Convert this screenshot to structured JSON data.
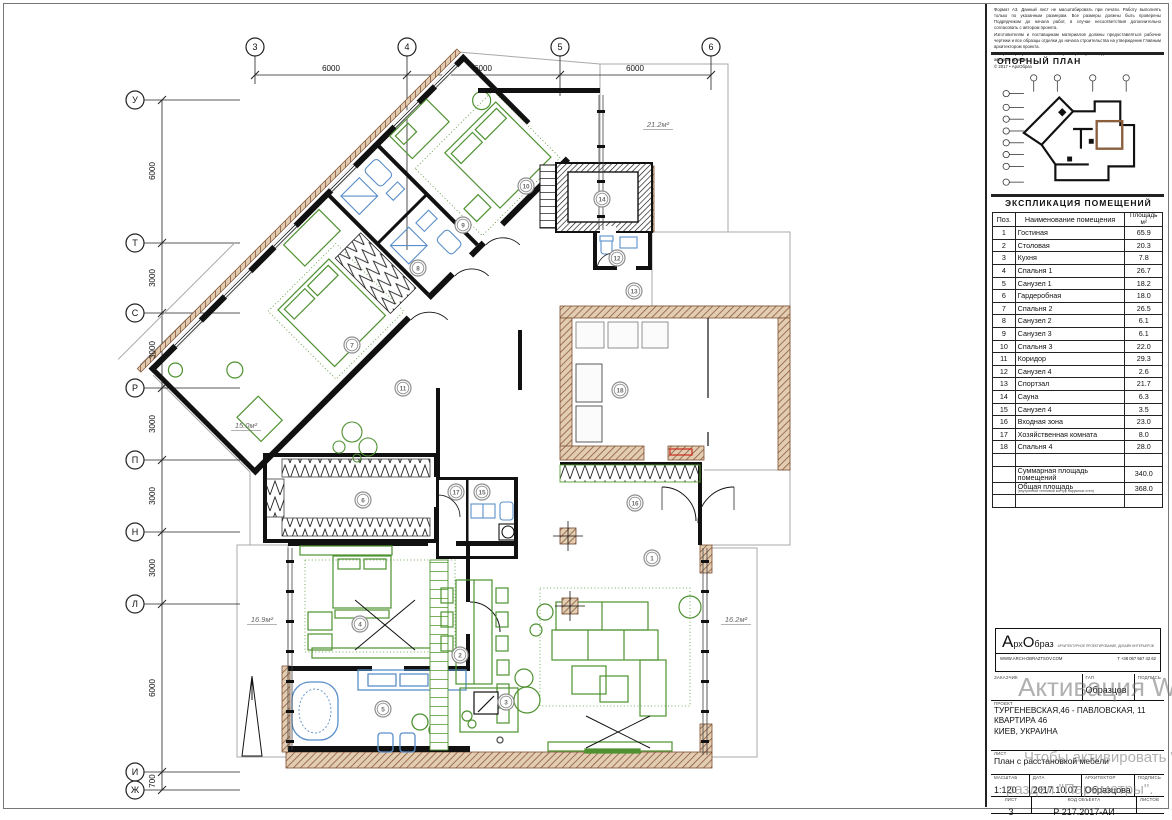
{
  "disclaimer": {
    "p1": "Формат А3. Данный лист не масштабировать при печати. Работу выполнять только по указанным размерам. Все размеры должны быть проверены Подрядчиком до начала работ, в случае несоответствия дополнительно согласовать с автором проекта.",
    "p2": "Изготовителям и поставщикам материалов должны предоставляться рабочие чертежи и все образцы отделки до начала строительства на утверждение Главным архитектором проекта.",
    "p3": "Все размеры указаны в мм, если размер не указан, дополнительно согласовать с автором проекта.",
    "copyright": "© 2017 • АрхОбраз"
  },
  "reference_plan": {
    "title": "ОПОРНЫЙ ПЛАН"
  },
  "explication": {
    "title": "ЭКСПЛИКАЦИЯ ПОМЕЩЕНИЙ",
    "col_pos": "Поз.",
    "col_name": "Наименование помещения",
    "col_area": "Площадь",
    "col_area_unit": "м²",
    "rows": [
      [
        "1",
        "Гостиная",
        "65.9"
      ],
      [
        "2",
        "Столовая",
        "20.3"
      ],
      [
        "3",
        "Кухня",
        "7.8"
      ],
      [
        "4",
        "Спальня 1",
        "26.7"
      ],
      [
        "5",
        "Санузел 1",
        "18.2"
      ],
      [
        "6",
        "Гардеробная",
        "18.0"
      ],
      [
        "7",
        "Спальня 2",
        "26.5"
      ],
      [
        "8",
        "Санузел 2",
        "6.1"
      ],
      [
        "9",
        "Санузел 3",
        "6.1"
      ],
      [
        "10",
        "Спальня 3",
        "22.0"
      ],
      [
        "11",
        "Коридор",
        "29.3"
      ],
      [
        "12",
        "Санузел 4",
        "2.6"
      ],
      [
        "13",
        "Спортзал",
        "21.7"
      ],
      [
        "14",
        "Сауна",
        "6.3"
      ],
      [
        "15",
        "Санузел 4",
        "3.5"
      ],
      [
        "16",
        "Входная зона",
        "23.0"
      ],
      [
        "17",
        "Хозяйственная комната",
        "8.0"
      ],
      [
        "18",
        "Спальня 4",
        "28.0"
      ]
    ],
    "total_label": "Суммарная площадь помещений",
    "total_value": "340.0",
    "overall_label": "Общая площадь",
    "overall_note": "(внутренний тепловой контур наружных стен)",
    "overall_value": "368.0"
  },
  "brand": {
    "name_a": "А",
    "name_rx": "рх",
    "name_o": "О",
    "name_braz": "браз",
    "tagline": "АРХИТЕКТУРНОЕ ПРОЕКТИРОВАНИЕ, ДИЗАЙН ИНТЕРЬЕРОВ",
    "website": "WWW.ARCH-OBRAZTSOV.COM",
    "phone": "Т +38 067 567 42 62"
  },
  "titleblock": {
    "customer_label": "ЗАКАЗЧИК",
    "gap_label": "ГАП",
    "gap_value": "Образцов",
    "signature_label": "ПОДПИСЬ",
    "project_label": "ПРОЕКТ",
    "project_line1": "ТУРГЕНЕВСКАЯ,46 - ПАВЛОВСКАЯ, 11",
    "project_line2": "КВАРТИРА 46",
    "project_line3": "КИЕВ, УКРАИНА",
    "sheet_label": "ЛИСТ",
    "sheet_title": "План с расстановкой мебели",
    "scale_label": "МАСШТАБ",
    "scale": "1:120",
    "date_label": "ДАТА",
    "date": "2017.10.07",
    "architect_label": "АРХИТЕКТОР",
    "architect": "Образцова",
    "signature2_label": "ПОДПИСЬ",
    "sheet_no_label": "ЛИСТ",
    "sheet_no": "3",
    "object_code_label": "КОД ОБЪЕКТА",
    "object_code": "Р 217.2017-АИ",
    "sheets_label": "ЛИСТОВ"
  },
  "watermark": {
    "line1": "Активация Windows",
    "line2": "Чтобы активировать Windows, перейдите в",
    "line3": "раздел \"Параметры\"."
  },
  "plan": {
    "grid_top": [
      "3",
      "4",
      "5",
      "6"
    ],
    "grid_left": [
      "У",
      "Т",
      "С",
      "Р",
      "П",
      "Н",
      "Л",
      "И",
      "Ж"
    ],
    "dims_top": [
      "6000",
      "6000",
      "6000"
    ],
    "dims_left": [
      "6000",
      "3000",
      "3000",
      "3000",
      "3000",
      "3000",
      "6000",
      "700"
    ],
    "room_numbers": [
      "1",
      "2",
      "3",
      "4",
      "5",
      "6",
      "7",
      "8",
      "9",
      "10",
      "11",
      "12",
      "13",
      "14",
      "15",
      "16",
      "17",
      "18"
    ],
    "area_labels": [
      "21.2м²",
      "15.0м²",
      "16.9м²",
      "16.2м²"
    ]
  }
}
